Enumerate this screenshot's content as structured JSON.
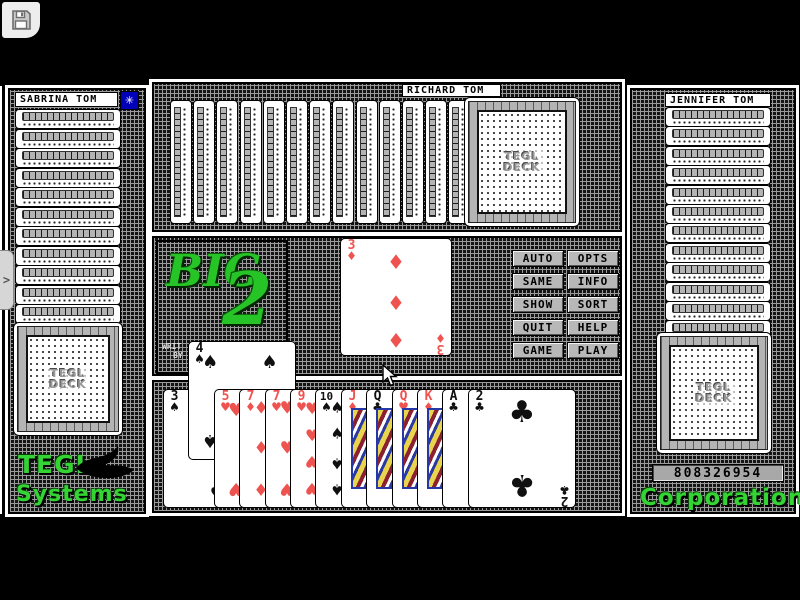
{
  "window": {
    "save_button_icon": "floppy-disk"
  },
  "side_tab": {
    "icon": "chevron-right",
    "glyph": ">"
  },
  "players": {
    "west": {
      "name": "SABRINA TOM",
      "turn_badge_icon": "star",
      "turn_badge_glyph": "✳",
      "hidden_card_count": 12
    },
    "north": {
      "name": "RICHARD TOM",
      "hidden_card_count": 14
    },
    "east": {
      "name": "JENNIFER TOM",
      "hidden_card_count": 13,
      "score": "808326954"
    }
  },
  "deck_back_label": {
    "line1": "TEGL",
    "line2": "DECK"
  },
  "branding": {
    "game_logo": {
      "word": "BIG",
      "number": "2"
    },
    "credit": {
      "line1": "WRIT",
      "line2": "BY"
    },
    "vendor_bottom_left": {
      "line1": "TEGL",
      "line2": "Systems"
    },
    "vendor_bottom_right": "Corporation"
  },
  "action_buttons": [
    "AUTO",
    "OPTS",
    "SAME",
    "INFO",
    "SHOW",
    "SORT",
    "QUIT",
    "HELP",
    "GAME",
    "PLAY"
  ],
  "table": {
    "played_card": {
      "rank": "3",
      "suit": "diamond"
    }
  },
  "hand": {
    "cards": [
      {
        "rank": "3",
        "suit": "spade",
        "raised": false
      },
      {
        "rank": "4",
        "suit": "spade",
        "raised": true
      },
      {
        "rank": "5",
        "suit": "heart",
        "raised": false
      },
      {
        "rank": "7",
        "suit": "diamond",
        "raised": false
      },
      {
        "rank": "7",
        "suit": "heart",
        "raised": false
      },
      {
        "rank": "9",
        "suit": "heart",
        "raised": false
      },
      {
        "rank": "10",
        "suit": "spade",
        "raised": false
      },
      {
        "rank": "J",
        "suit": "diamond",
        "raised": false
      },
      {
        "rank": "Q",
        "suit": "club",
        "raised": false
      },
      {
        "rank": "Q",
        "suit": "heart",
        "raised": false
      },
      {
        "rank": "K",
        "suit": "diamond",
        "raised": false
      },
      {
        "rank": "A",
        "suit": "club",
        "raised": false
      },
      {
        "rank": "2",
        "suit": "club",
        "raised": false
      }
    ]
  },
  "suit_symbols": {
    "spade": "♠",
    "heart": "♥",
    "diamond": "♦",
    "club": "♣"
  },
  "colors": {
    "red_suit": "#ef5350",
    "black_suit": "#101010",
    "logo_green": "#35d435",
    "badge_blue": "#0000b8",
    "card_white": "#ffffff",
    "background": "#000000"
  }
}
